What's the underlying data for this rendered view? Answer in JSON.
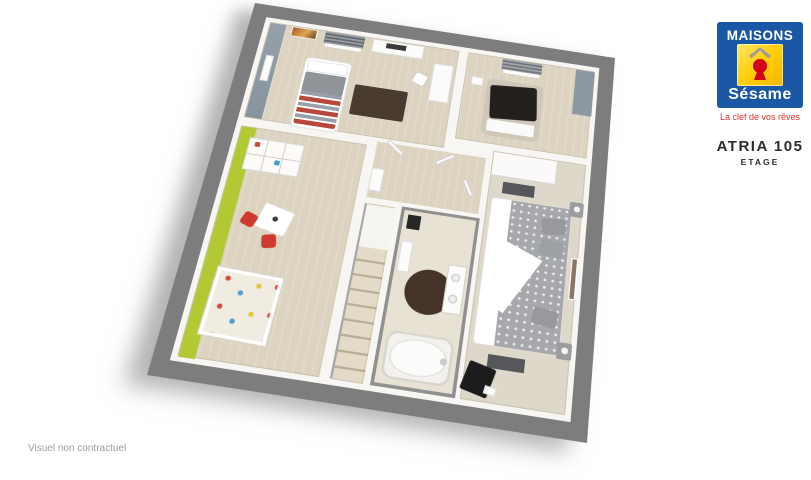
{
  "brand": {
    "name_top": "MAISONS",
    "name_bottom": "Sésame",
    "tagline": "La clef de vos rêves",
    "icons": {
      "roof-icon": "gray chevron roof above keyhole",
      "keyhole-icon": "red keyhole on yellow square"
    },
    "colors": {
      "blue": "#1a57a5",
      "yellow": "#ffcc00",
      "keyhole_red": "#d30019",
      "tagline_red": "#d6362c"
    }
  },
  "plan": {
    "title": "ATRIA 105",
    "subtitle": "ETAGE"
  },
  "footer": {
    "disclaimer": "Visuel non contractuel"
  },
  "floorplan": {
    "view": "3D isometric upper-floor plan, tilted clockwise, drop shadow lower-left",
    "colors": {
      "outer_wall_gray": "#7d7d7d",
      "floor_wood_beige": "#dcd3c0",
      "floor_carpet": "#ddd8ca",
      "bathroom_floor": "#e8e2d5",
      "accent_blue_gray": "#8e9aa3",
      "accent_green": "#b2c934",
      "rug_dark_brown": "#45332a",
      "rug_brown": "#4a3b30",
      "chair_red": "#ce3a2e",
      "dark_blanket": "#23201d"
    }
  }
}
